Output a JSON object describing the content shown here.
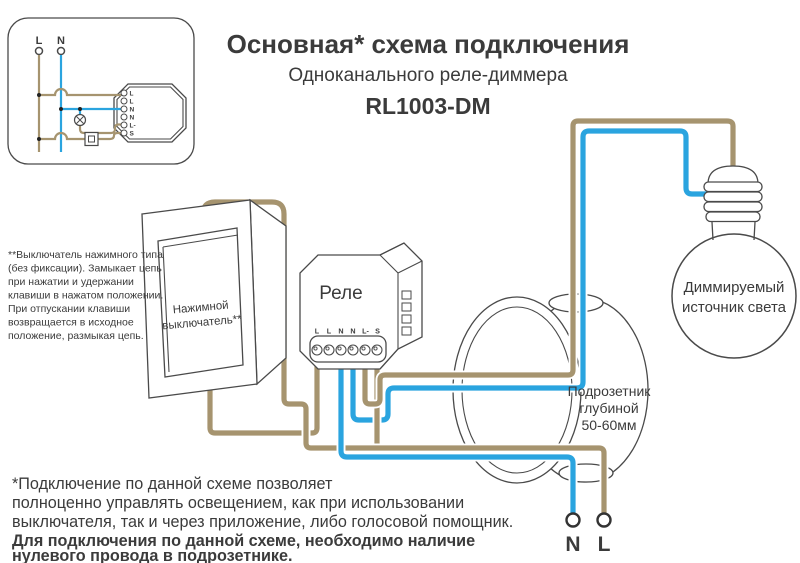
{
  "title": {
    "main": "Основная* схема подключения",
    "sub": "Одноканального реле-диммера",
    "model": "RL1003-DM"
  },
  "inset": {
    "l": "L",
    "n": "N",
    "terminals": [
      "L",
      "L",
      "N",
      "N",
      "L-",
      "S"
    ]
  },
  "relay": {
    "label": "Реле",
    "terminals": [
      "L",
      "L",
      "N",
      "N",
      "L-",
      "S"
    ]
  },
  "switch": {
    "line1": "Нажимной",
    "line2": "выключатель**"
  },
  "box": {
    "line1": "Подрозетник",
    "line2": "глубиной",
    "line3": "50-60мм"
  },
  "bulb": {
    "line1": "Диммируемый",
    "line2": "источник света"
  },
  "mains": {
    "n": "N",
    "l": "L"
  },
  "switch_note": {
    "lines": [
      "**Выключатель нажимного типа",
      "(без фиксации). Замыкает цепь",
      "при нажатии и удержании",
      "клавиши в нажатом положении.",
      "При отпускании клавиши",
      "возвращается в исходное",
      "положение, размыкая цепь."
    ]
  },
  "footnote": {
    "lines": [
      "*Подключение по данной схеме позволяет",
      "полноценно управлять освещением, как при использовании",
      "выключателя, так и через приложение, либо голосовой помощник."
    ],
    "bold_lines": [
      "Для подключения по данной схеме, необходимо наличие",
      "нулевого провода в подрозетнике."
    ]
  },
  "colors": {
    "wire_l": "#a6946f",
    "wire_n": "#2aa4df",
    "outline": "#4a4a4a",
    "text": "#3b3b3b"
  }
}
